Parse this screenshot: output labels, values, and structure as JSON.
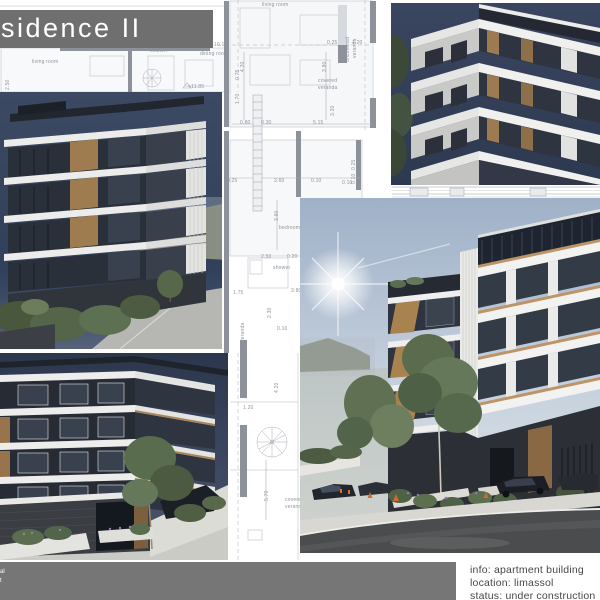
{
  "title": {
    "text": "sidence II"
  },
  "footer": {
    "fragments": [
      "al",
      "t"
    ],
    "info_lines": [
      "info: apartment building",
      "location: limassol",
      "status: under construction"
    ]
  },
  "colors": {
    "banner_gray": "#6f6f6f",
    "footer_gray": "#767676",
    "title_text": "#ffffff",
    "info_text": "#474747",
    "plan_label": "#8f949d",
    "plan_line": "#c7cbd2",
    "wood_accent": "#b58d58",
    "dusk_sky": "#34405a",
    "day_sky": "#a3b4ca",
    "asphalt": "#4b4c4d"
  },
  "plan": {
    "labels": [
      {
        "t": "living room",
        "x": 262,
        "y": 3
      },
      {
        "t": "uncovered",
        "x": 346,
        "y": 62,
        "v": 1
      },
      {
        "t": "veranda",
        "x": 353,
        "y": 58,
        "v": 1
      },
      {
        "t": "4.20",
        "x": 241,
        "y": 72,
        "v": 1
      },
      {
        "t": "3.80",
        "x": 323,
        "y": 72,
        "v": 1
      },
      {
        "t": "0.25",
        "x": 327,
        "y": 41
      },
      {
        "t": "1.20",
        "x": 352,
        "y": 41
      },
      {
        "t": "10.10",
        "x": 214,
        "y": 43
      },
      {
        "t": "kitchen",
        "x": 150,
        "y": 49
      },
      {
        "t": "dining room",
        "x": 200,
        "y": 52
      },
      {
        "t": "living room",
        "x": 32,
        "y": 60
      },
      {
        "t": "2.50",
        "x": 6,
        "y": 90,
        "v": 1
      },
      {
        "t": "+11.85",
        "x": 188,
        "y": 85
      },
      {
        "t": "0.75",
        "x": 236,
        "y": 80,
        "v": 1
      },
      {
        "t": "1.70",
        "x": 236,
        "y": 104,
        "v": 1
      },
      {
        "t": "covered",
        "x": 318,
        "y": 79
      },
      {
        "t": "veranda",
        "x": 318,
        "y": 86
      },
      {
        "t": "3.20",
        "x": 331,
        "y": 116,
        "v": 1
      },
      {
        "t": "0.80",
        "x": 240,
        "y": 121
      },
      {
        "t": "0.30",
        "x": 261,
        "y": 121
      },
      {
        "t": "5.15",
        "x": 313,
        "y": 121
      },
      {
        "t": "0.25",
        "x": 227,
        "y": 179
      },
      {
        "t": "3.60",
        "x": 274,
        "y": 179
      },
      {
        "t": "0.10",
        "x": 311,
        "y": 179
      },
      {
        "t": "0.10",
        "x": 342,
        "y": 181
      },
      {
        "t": "0.25",
        "x": 352,
        "y": 170,
        "v": 1
      },
      {
        "t": "0.10",
        "x": 352,
        "y": 184,
        "v": 1
      },
      {
        "t": "3.60",
        "x": 275,
        "y": 221,
        "v": 1
      },
      {
        "t": "bedroom",
        "x": 279,
        "y": 226
      },
      {
        "t": "2.50",
        "x": 261,
        "y": 255
      },
      {
        "t": "0.20",
        "x": 287,
        "y": 255
      },
      {
        "t": "shower",
        "x": 273,
        "y": 266
      },
      {
        "t": "1.75",
        "x": 233,
        "y": 291
      },
      {
        "t": "3.80",
        "x": 291,
        "y": 289
      },
      {
        "t": "veranda",
        "x": 241,
        "y": 342,
        "v": 1
      },
      {
        "t": "2.30",
        "x": 268,
        "y": 318,
        "v": 1
      },
      {
        "t": "0.10",
        "x": 277,
        "y": 327
      },
      {
        "t": "4.20",
        "x": 275,
        "y": 393,
        "v": 1
      },
      {
        "t": "1.20",
        "x": 243,
        "y": 406
      },
      {
        "t": "5.70",
        "x": 265,
        "y": 501,
        "v": 1
      },
      {
        "t": "covered",
        "x": 285,
        "y": 498
      },
      {
        "t": "veranda",
        "x": 285,
        "y": 505
      }
    ]
  }
}
